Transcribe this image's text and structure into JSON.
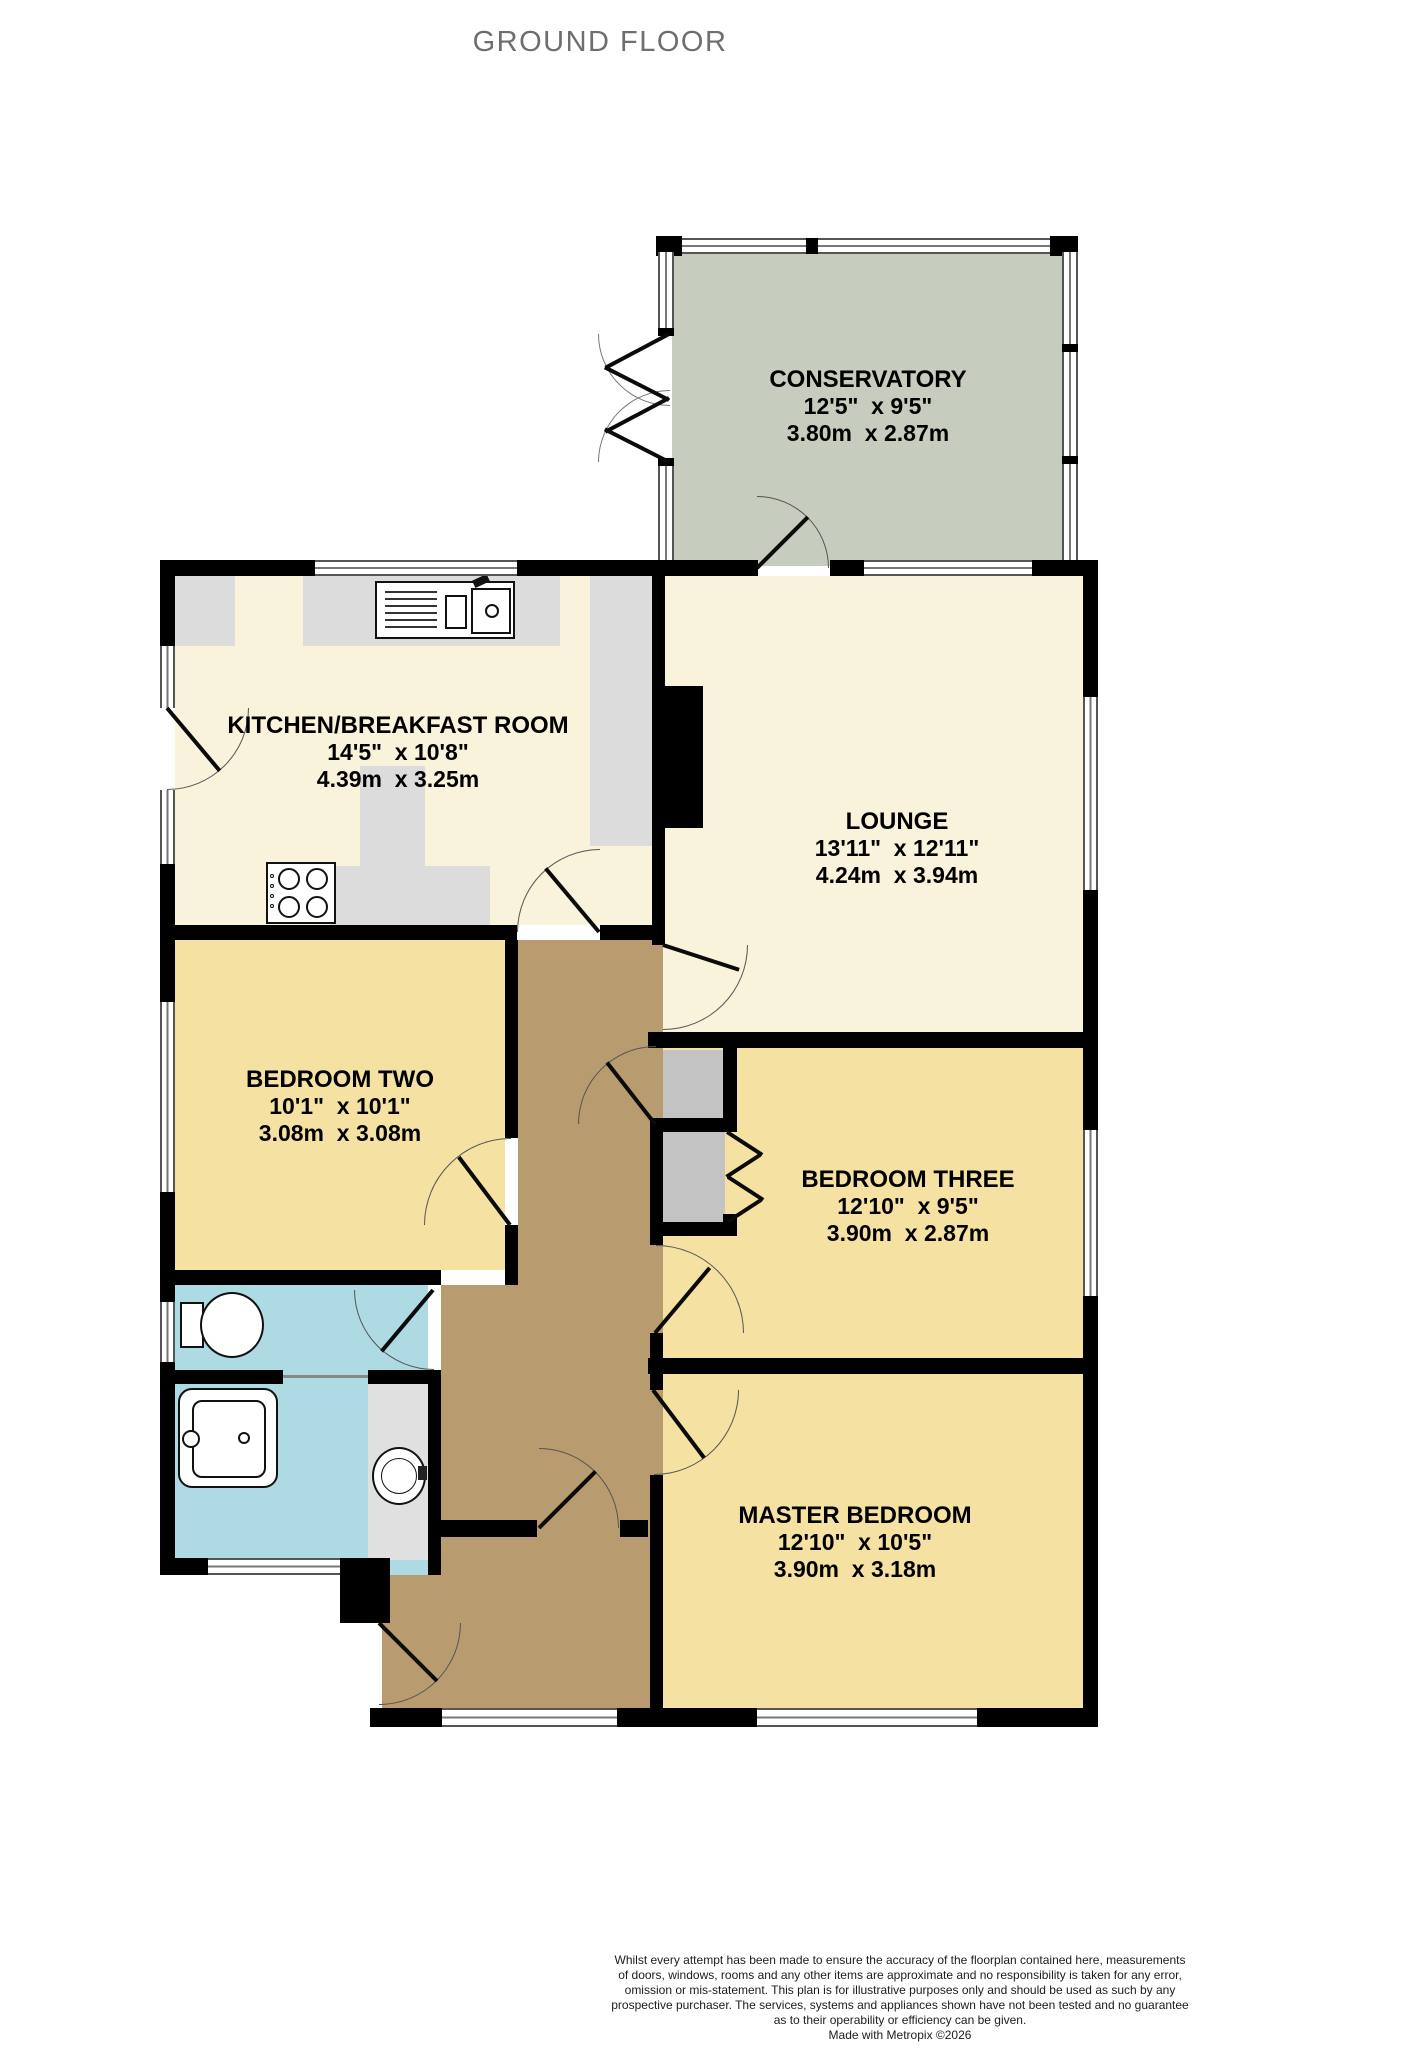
{
  "title": "GROUND FLOOR",
  "rooms": {
    "conservatory": {
      "name": "CONSERVATORY",
      "imperial": "12'5\"  x 9'5\"",
      "metric": "3.80m  x 2.87m"
    },
    "kitchen": {
      "name": "KITCHEN/BREAKFAST ROOM",
      "imperial": "14'5\"  x 10'8\"",
      "metric": "4.39m  x 3.25m"
    },
    "lounge": {
      "name": "LOUNGE",
      "imperial": "13'11\"  x 12'11\"",
      "metric": "4.24m  x 3.94m"
    },
    "bedroom_two": {
      "name": "BEDROOM TWO",
      "imperial": "10'1\"  x 10'1\"",
      "metric": "3.08m  x 3.08m"
    },
    "bedroom_three": {
      "name": "BEDROOM THREE",
      "imperial": "12'10\"  x 9'5\"",
      "metric": "3.90m  x 2.87m"
    },
    "master_bedroom": {
      "name": "MASTER BEDROOM",
      "imperial": "12'10\"  x 10'5\"",
      "metric": "3.90m  x 3.18m"
    }
  },
  "fixtures": [
    "kitchen-sink",
    "hob",
    "toilet",
    "bath",
    "wash-basin"
  ],
  "colors": {
    "wall": "#000000",
    "cream_room": "#f8f3da",
    "yellow_room": "#f5e2a2",
    "sage_room": "#c6ccbe",
    "hall_tan": "#b99b70",
    "bathroom_blue": "#aedae3",
    "counter_gray": "#dcdcdc",
    "closet_gray": "#c3c3c3",
    "vanity_gray": "#e0e0e0",
    "title_gray": "#6e6e6e"
  },
  "footer": {
    "lines": [
      "Whilst every attempt has been made to ensure the accuracy of the floorplan contained here, measurements",
      "of doors, windows, rooms and any other items are approximate and no responsibility is taken for any error,",
      "omission or mis-statement. This plan is for illustrative purposes only and should be used as such by any",
      "prospective purchaser. The services, systems and appliances shown have not been tested and no guarantee",
      "as to their operability or efficiency can be given."
    ],
    "credit": "Made with Metropix ©2026"
  }
}
